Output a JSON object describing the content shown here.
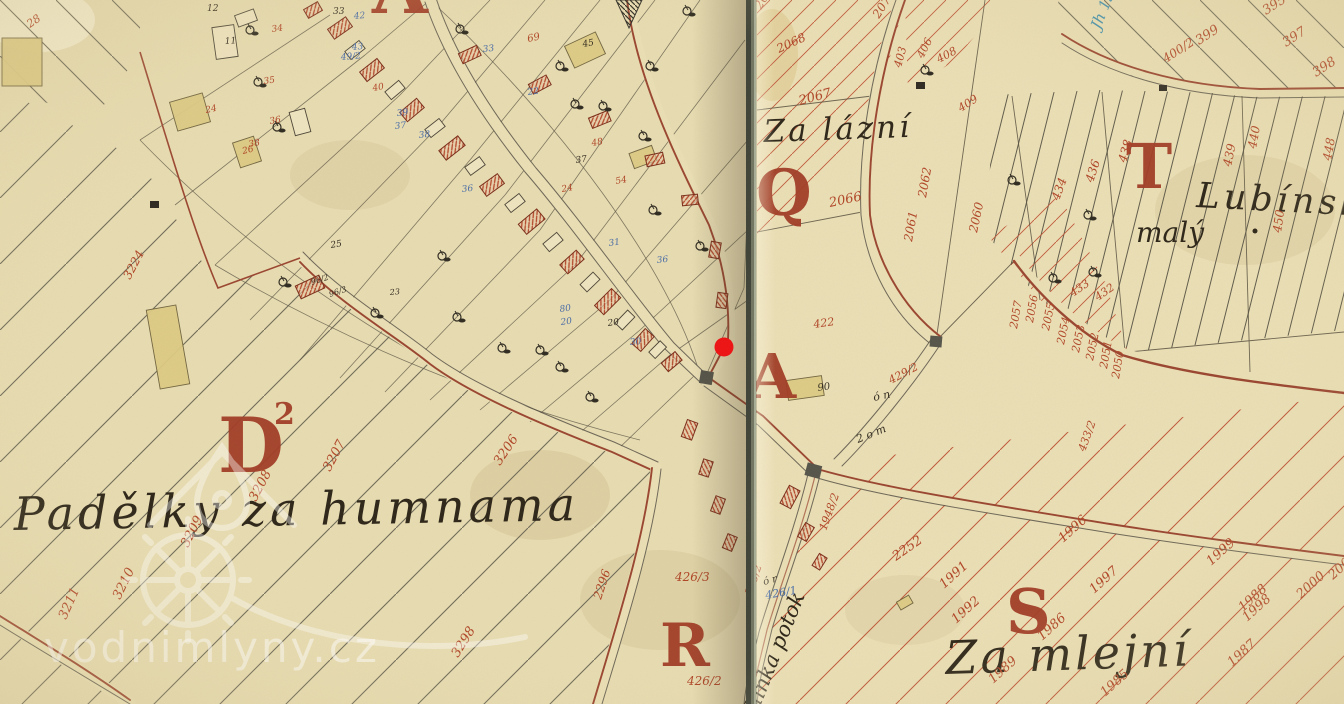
{
  "map": {
    "colors": {
      "paper": "#e8dcb2",
      "fold_line": "#3e4237",
      "letter_red": "#a23c26",
      "number_red": "#b04527",
      "number_blue": "#4a6da8",
      "number_black": "#332c20",
      "ink_teal": "#3f8fae",
      "road_brown": "#9a4530",
      "hatch_gray": "#6e6a58",
      "hatch_red": "#c0583a",
      "parcel_yellow": "#ddcb84",
      "marker_red": "#ee1113",
      "watermark_white": "#ffffff"
    },
    "watermark": {
      "text": "vodnimlyny.cz"
    },
    "section_letters": [
      {
        "text": "D",
        "x": 218,
        "y": 472,
        "size": 76
      },
      {
        "text": "2",
        "x": 274,
        "y": 424,
        "size": 30
      },
      {
        "text": "Q",
        "x": 756,
        "y": 215,
        "size": 64
      },
      {
        "text": "A",
        "x": 748,
        "y": 398,
        "size": 62
      },
      {
        "text": "T",
        "x": 1126,
        "y": 188,
        "size": 62
      },
      {
        "text": "R",
        "x": 660,
        "y": 666,
        "size": 60
      },
      {
        "text": "S",
        "x": 1006,
        "y": 633,
        "size": 62
      },
      {
        "text": "A",
        "x": 372,
        "y": 13,
        "size": 72
      }
    ],
    "place_labels": [
      {
        "id": "padelky",
        "text": "Padělky za humnama"
      },
      {
        "id": "zalazni",
        "text": "Za lázní"
      },
      {
        "id": "lubinsky",
        "text": "Lubínský"
      },
      {
        "id": "maly",
        "text": "malý"
      },
      {
        "id": "zamlejni",
        "text": "Za mlejní"
      },
      {
        "id": "potok",
        "text": "hinka potok"
      }
    ],
    "parcel_numbers": [
      [
        "3206",
        500,
        466,
        -56,
        "r",
        13
      ],
      [
        "3207",
        330,
        472,
        -62,
        "r",
        13
      ],
      [
        "3208",
        256,
        502,
        -62,
        "r",
        13
      ],
      [
        "3209",
        188,
        548,
        -63,
        "r",
        13
      ],
      [
        "3210",
        120,
        600,
        -64,
        "r",
        13
      ],
      [
        "3211",
        66,
        620,
        -66,
        "r",
        13
      ],
      [
        "3224",
        130,
        280,
        -62,
        "r",
        12
      ],
      [
        "3298",
        458,
        658,
        -58,
        "r",
        13
      ],
      [
        "2296",
        601,
        600,
        -72,
        "r",
        12
      ],
      [
        "1985",
        1105,
        697,
        -42,
        "r",
        13
      ],
      [
        "1986",
        1042,
        641,
        -42,
        "r",
        13
      ],
      [
        "1987",
        1232,
        667,
        -42,
        "r",
        13
      ],
      [
        "1988",
        1243,
        612,
        -42,
        "r",
        13
      ],
      [
        "1989",
        993,
        684,
        -42,
        "r",
        13
      ],
      [
        "1991",
        944,
        589,
        -42,
        "r",
        13
      ],
      [
        "1992",
        956,
        624,
        -42,
        "r",
        13
      ],
      [
        "1996",
        1063,
        543,
        -42,
        "r",
        13
      ],
      [
        "1997",
        1094,
        594,
        -42,
        "r",
        13
      ],
      [
        "1998",
        1247,
        622,
        -42,
        "r",
        13
      ],
      [
        "1999",
        1211,
        566,
        -42,
        "r",
        13
      ],
      [
        "2000",
        1301,
        599,
        -42,
        "r",
        13
      ],
      [
        "2001",
        1333,
        580,
        -42,
        "r",
        13
      ],
      [
        "2252",
        896,
        561,
        -35,
        "r",
        13
      ],
      [
        "2060",
        977,
        233,
        -78,
        "r",
        12
      ],
      [
        "2061",
        912,
        242,
        -80,
        "r",
        12
      ],
      [
        "2062",
        926,
        198,
        -80,
        "r",
        12
      ],
      [
        "2066",
        830,
        207,
        -12,
        "r",
        13
      ],
      [
        "2067",
        800,
        105,
        -15,
        "r",
        13
      ],
      [
        "2068",
        779,
        53,
        -25,
        "r",
        12
      ],
      [
        "2075",
        761,
        10,
        -60,
        "r",
        12
      ],
      [
        "2076",
        879,
        19,
        -58,
        "r",
        12
      ],
      [
        "2050",
        1119,
        379,
        -80,
        "r",
        11
      ],
      [
        "2051",
        1107,
        369,
        -80,
        "r",
        11
      ],
      [
        "2052",
        1093,
        361,
        -78,
        "r",
        11
      ],
      [
        "2053",
        1079,
        353,
        -78,
        "r",
        11
      ],
      [
        "2054",
        1064,
        345,
        -78,
        "r",
        11
      ],
      [
        "2055",
        1049,
        331,
        -78,
        "r",
        11
      ],
      [
        "2056",
        1033,
        323,
        -80,
        "r",
        11
      ],
      [
        "2057",
        1017,
        329,
        -80,
        "r",
        11
      ],
      [
        "432",
        1098,
        301,
        -35,
        "r",
        11
      ],
      [
        "433",
        1073,
        297,
        -35,
        "r",
        11
      ],
      [
        "422",
        814,
        328,
        -8,
        "r",
        11
      ],
      [
        "429/2",
        891,
        384,
        -28,
        "r",
        11
      ],
      [
        "433/2",
        1085,
        452,
        -70,
        "r",
        11
      ],
      [
        "403",
        901,
        68,
        -75,
        "r",
        11
      ],
      [
        "406",
        923,
        59,
        -63,
        "r",
        11
      ],
      [
        "408",
        939,
        63,
        -28,
        "r",
        11
      ],
      [
        "409",
        961,
        112,
        -33,
        "r",
        11
      ],
      [
        "434",
        1059,
        201,
        -70,
        "r",
        12
      ],
      [
        "436",
        1093,
        183,
        -72,
        "r",
        12
      ],
      [
        "438",
        1126,
        163,
        -74,
        "r",
        12
      ],
      [
        "439",
        1231,
        167,
        -78,
        "r",
        12
      ],
      [
        "440",
        1256,
        149,
        -80,
        "r",
        12
      ],
      [
        "448",
        1331,
        161,
        -80,
        "r",
        12
      ],
      [
        "450",
        1281,
        233,
        -82,
        "r",
        12
      ],
      [
        "395",
        1266,
        15,
        -33,
        "r",
        13
      ],
      [
        "397",
        1286,
        47,
        -33,
        "r",
        13
      ],
      [
        "398",
        1316,
        77,
        -33,
        "r",
        13
      ],
      [
        "399",
        1199,
        45,
        -33,
        "r",
        13
      ],
      [
        "400/2",
        1166,
        63,
        -33,
        "r",
        12
      ],
      [
        "365/2",
        752,
        596,
        -72,
        "r",
        11
      ],
      [
        "1948/2",
        826,
        531,
        -70,
        "r",
        11
      ],
      [
        "426/3",
        675,
        581,
        0,
        "r",
        12
      ],
      [
        "426/2",
        687,
        685,
        0,
        "r",
        12
      ],
      [
        "426/1",
        766,
        599,
        -10,
        "b",
        11
      ],
      [
        "34",
        272,
        32,
        -8,
        "r",
        9
      ],
      [
        "35",
        264,
        84,
        -8,
        "r",
        9
      ],
      [
        "36",
        270,
        124,
        -10,
        "r",
        9
      ],
      [
        "38",
        249,
        147,
        -10,
        "r",
        9
      ],
      [
        "24",
        206,
        113,
        -12,
        "r",
        9
      ],
      [
        "26",
        243,
        154,
        -14,
        "r",
        9
      ],
      [
        "40",
        373,
        91,
        -10,
        "r",
        9
      ],
      [
        "69",
        528,
        42,
        -12,
        "r",
        10
      ],
      [
        "24",
        562,
        192,
        -10,
        "r",
        9
      ],
      [
        "54",
        616,
        184,
        -10,
        "r",
        9
      ],
      [
        "48",
        592,
        146,
        -10,
        "r",
        9
      ],
      [
        "28",
        30,
        28,
        -35,
        "r",
        11
      ],
      [
        "42",
        354,
        19,
        -5,
        "b",
        9
      ],
      [
        "39",
        397,
        116,
        -6,
        "b",
        9
      ],
      [
        "37",
        395,
        129,
        -6,
        "b",
        9
      ],
      [
        "38",
        419,
        138,
        -6,
        "b",
        9
      ],
      [
        "49/2",
        341,
        60,
        -5,
        "b",
        9
      ],
      [
        "22",
        528,
        95,
        -8,
        "b",
        9
      ],
      [
        "33",
        483,
        52,
        -6,
        "b",
        9
      ],
      [
        "80",
        560,
        312,
        -8,
        "b",
        9
      ],
      [
        "20",
        561,
        325,
        -8,
        "b",
        9
      ],
      [
        "30",
        630,
        345,
        -5,
        "b",
        9
      ],
      [
        "36",
        657,
        263,
        -6,
        "b",
        9
      ],
      [
        "31",
        609,
        246,
        -8,
        "b",
        9
      ],
      [
        "43",
        352,
        50,
        -5,
        "b",
        9
      ],
      [
        "36",
        462,
        192,
        -6,
        "b",
        9
      ],
      [
        "33",
        333,
        14,
        0,
        "k",
        9
      ],
      [
        "12",
        207,
        11,
        0,
        "k",
        9
      ],
      [
        "11",
        225,
        44,
        -4,
        "k",
        9
      ],
      [
        "25",
        331,
        248,
        -10,
        "k",
        9
      ],
      [
        "23",
        390,
        295,
        -5,
        "k",
        8
      ],
      [
        "96/2",
        312,
        285,
        -18,
        "k",
        8
      ],
      [
        "96/3",
        330,
        297,
        -18,
        "k",
        8
      ],
      [
        "20",
        608,
        326,
        -8,
        "k",
        9
      ],
      [
        "37",
        576,
        163,
        -8,
        "k",
        9
      ],
      [
        "45",
        583,
        47,
        -10,
        "k",
        9
      ],
      [
        "90",
        818,
        391,
        -8,
        "k",
        10
      ],
      [
        "ó n",
        874,
        401,
        -12,
        "k",
        11
      ],
      [
        "2 o m",
        858,
        443,
        -22,
        "k",
        11
      ],
      [
        "ó r",
        764,
        585,
        -15,
        "k",
        10
      ],
      [
        "Jh 15",
        1100,
        30,
        -68,
        "t",
        15
      ]
    ]
  }
}
